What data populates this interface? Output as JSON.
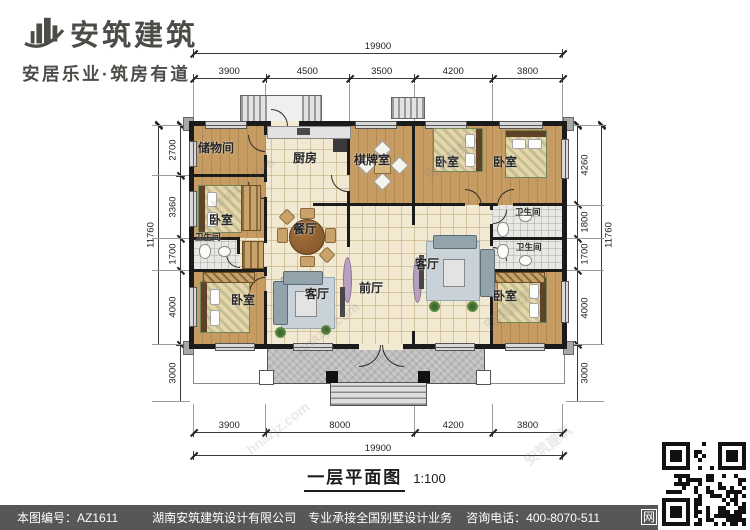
{
  "logo": {
    "company": "安筑建筑",
    "tagline": "安居乐业·筑房有道"
  },
  "plan": {
    "caption": {
      "title": "一层平面图",
      "scale": "1:100"
    },
    "rooms": [
      {
        "id": "storage",
        "label": "储物间"
      },
      {
        "id": "bedroom-left",
        "label": "卧室"
      },
      {
        "id": "bath-left",
        "label": "卫生间"
      },
      {
        "id": "bedroom-bottom-left",
        "label": "卧室"
      },
      {
        "id": "kitchen",
        "label": "厨房"
      },
      {
        "id": "dining",
        "label": "餐厅"
      },
      {
        "id": "living-left",
        "label": "客厅"
      },
      {
        "id": "chess-room",
        "label": "棋牌室"
      },
      {
        "id": "front-hall",
        "label": "前厅"
      },
      {
        "id": "living-right",
        "label": "客厅"
      },
      {
        "id": "bedroom-top-mid",
        "label": "卧室"
      },
      {
        "id": "bedroom-top-right",
        "label": "卧室"
      },
      {
        "id": "bath-right-upper",
        "label": "卫生间"
      },
      {
        "id": "bath-right-lower",
        "label": "卫生间"
      },
      {
        "id": "bedroom-bottom-right",
        "label": "卧室"
      }
    ],
    "dimensions": {
      "top_overall": "19900",
      "top_segments": [
        "3900",
        "4500",
        "3500",
        "4200",
        "3800"
      ],
      "bottom_segments": [
        "3900",
        "8000",
        "4200",
        "3800"
      ],
      "bottom_overall": "19900",
      "left_overall": "11760",
      "left_segments": [
        "2700",
        "3360",
        "1700",
        "4000",
        "3000"
      ],
      "right_segments": [
        "4260",
        "1800",
        "1700",
        "4000",
        "3000"
      ],
      "right_overall": "11760"
    }
  },
  "watermarks": [
    "hnazjz.com",
    "安筑建筑"
  ],
  "footer": {
    "drawing_no": "本图编号：AZ1611",
    "company": "湖南安筑建筑设计有限公司",
    "service": "专业承接全国别墅设计业务",
    "phone": "咨询电话：400-8070-511",
    "qr_label": "网"
  },
  "colors": {
    "wall": "#1b1b1b",
    "wood_floor": "#c79c63",
    "tile_floor": "#f2e9d2",
    "bath_floor": "#e7e7e3",
    "porch": "#bdbdbd",
    "footer_bg": "#57575a"
  }
}
